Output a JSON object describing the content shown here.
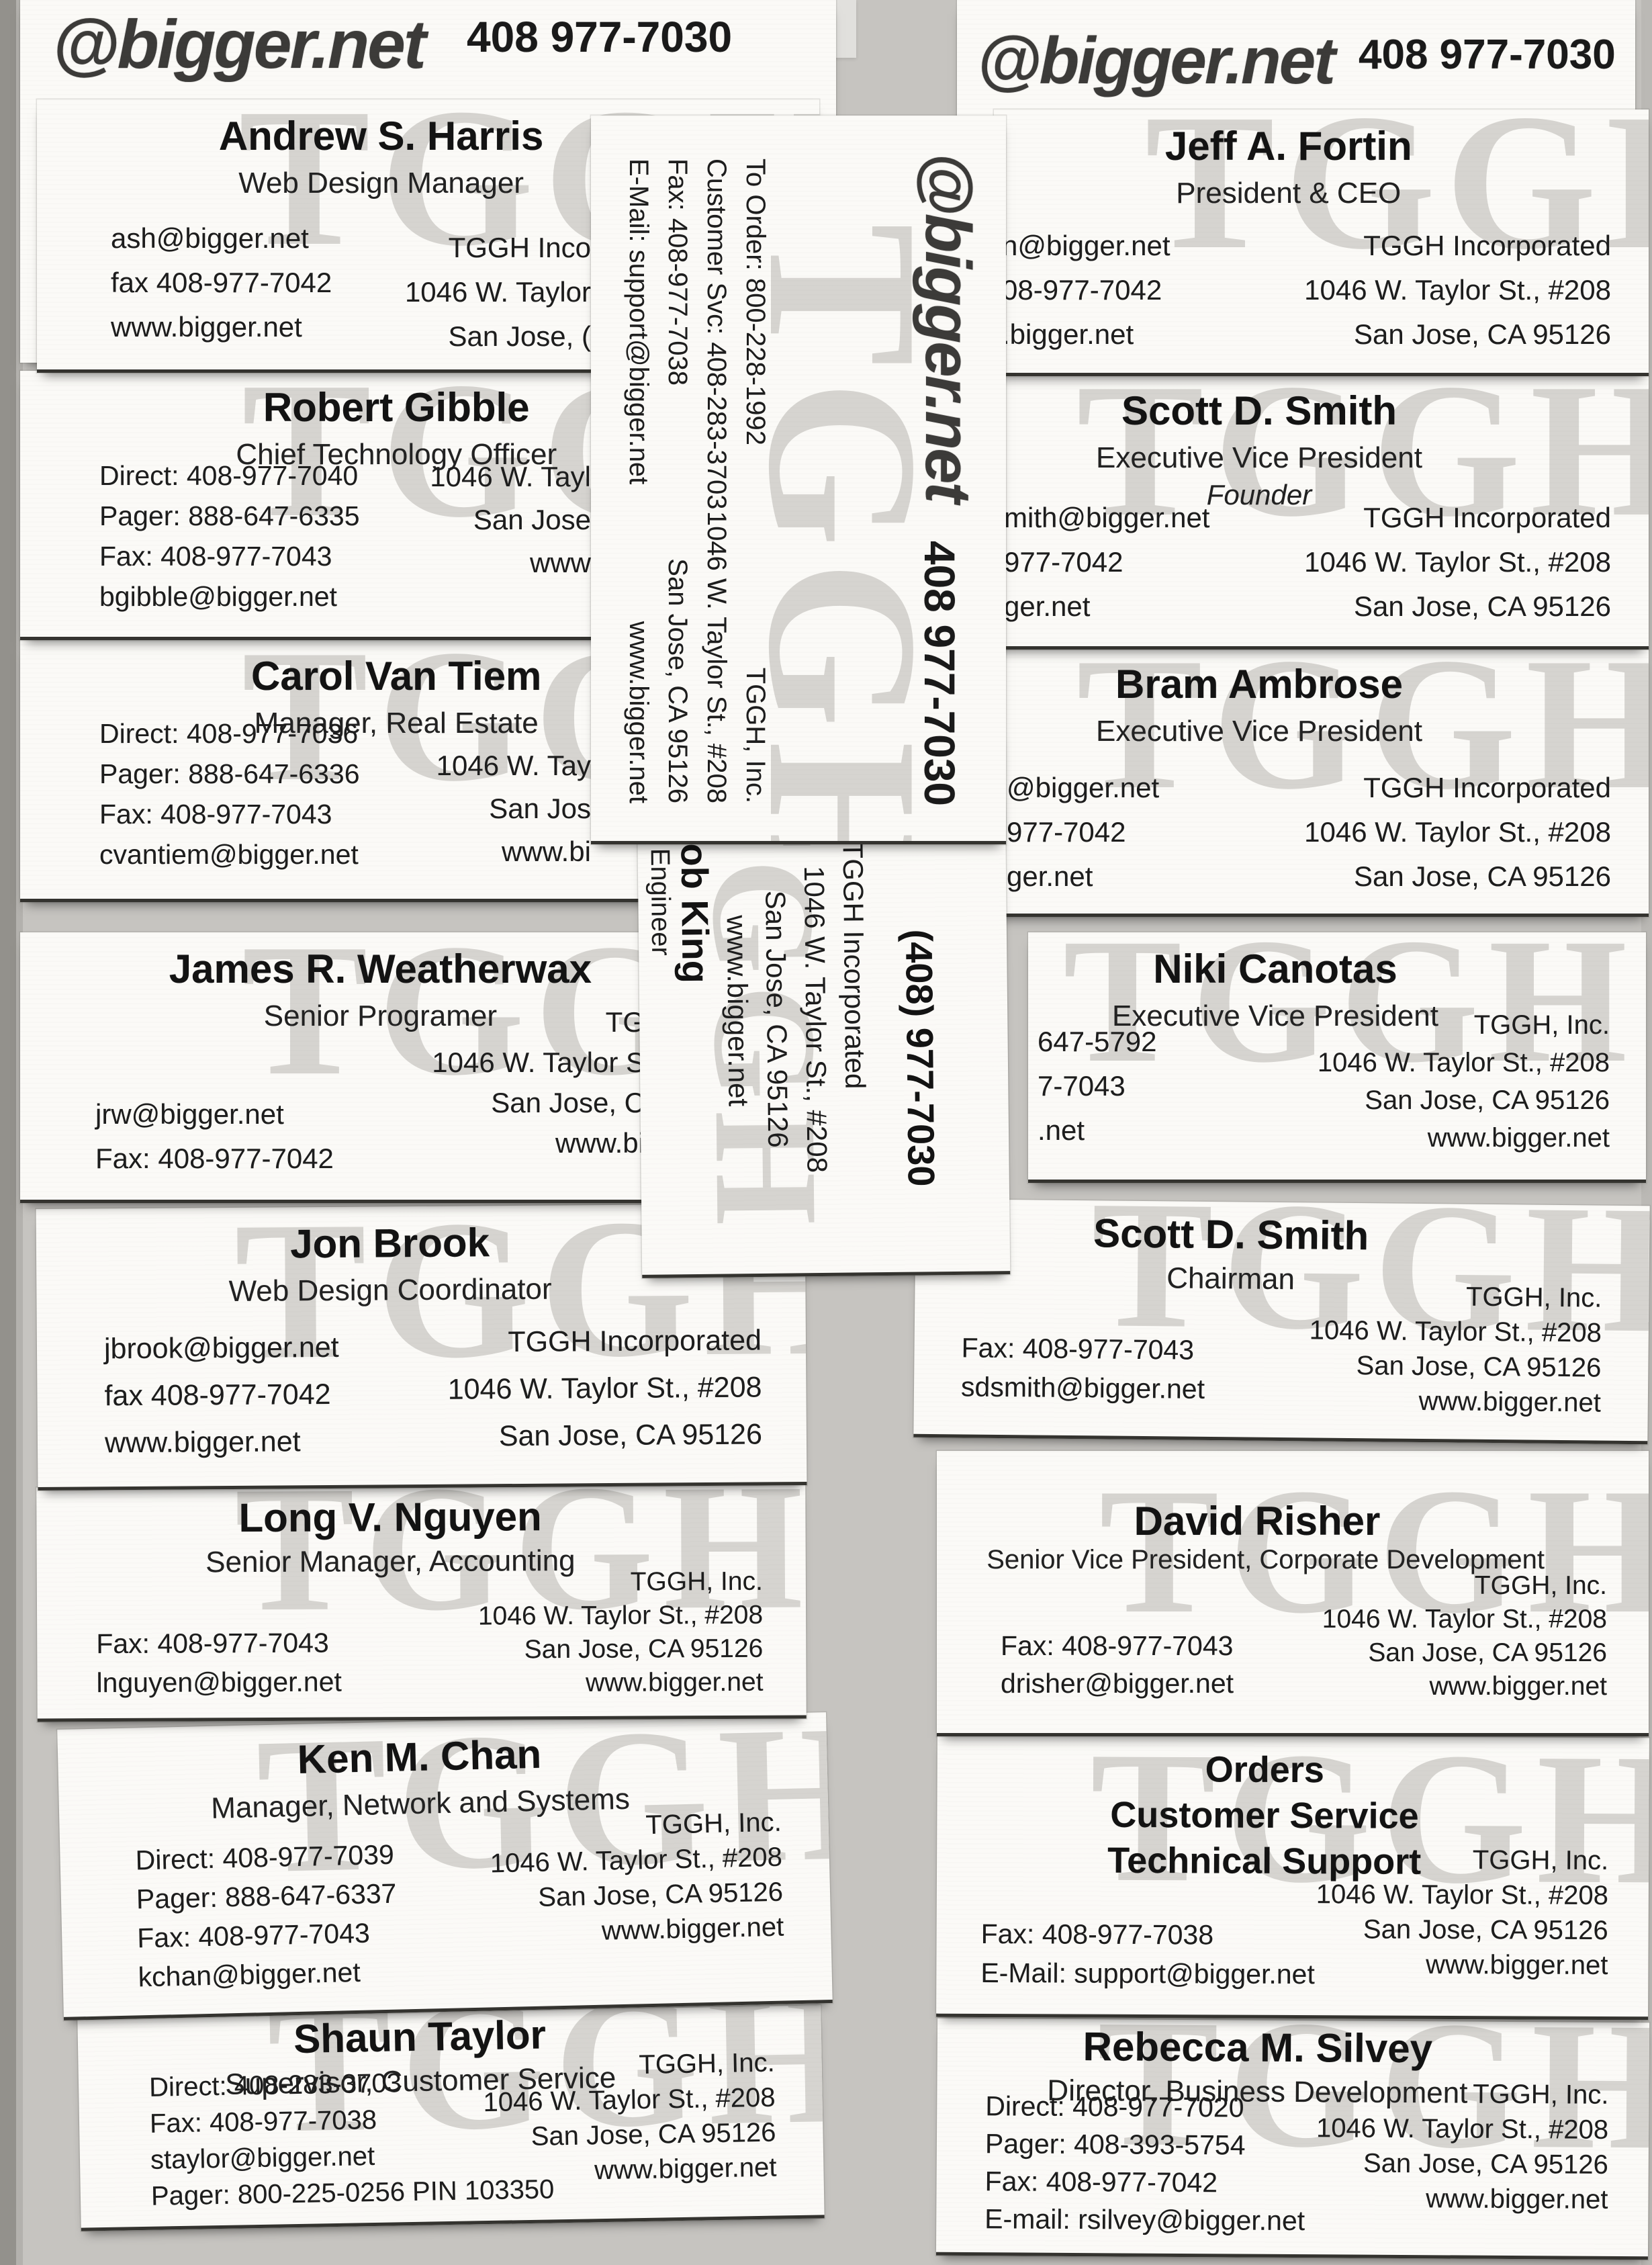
{
  "headers": {
    "left": {
      "logo": "@bigger.net",
      "phone": "408 977-7030"
    },
    "right": {
      "logo": "@bigger.net",
      "phone": "408 977-7030"
    }
  },
  "watermark": "TGGH",
  "cards": {
    "andrew": {
      "name": "Andrew S. Harris",
      "title": "Web Design Manager",
      "left": [
        "ash@bigger.net",
        "fax 408-977-7042",
        "www.bigger.net"
      ],
      "right": [
        "TGGH Inco",
        "1046 W. Taylor",
        "San Jose, ("
      ]
    },
    "fortin": {
      "name": "Jeff A. Fortin",
      "title": "President & CEO",
      "left": [
        "n@bigger.net",
        "08-977-7042",
        ".bigger.net"
      ],
      "right": [
        "TGGH Incorporated",
        "1046 W. Taylor St., #208",
        "San Jose, CA 95126"
      ]
    },
    "gibble": {
      "name": "Robert Gibble",
      "title": "Chief Technology Officer",
      "left": [
        "Direct: 408-977-7040",
        "Pager: 888-647-6335",
        "Fax: 408-977-7043",
        "bgibble@bigger.net"
      ],
      "right": [
        "1046 W. Tayl",
        "San Jose",
        "www"
      ]
    },
    "smith_evp": {
      "name": "Scott D. Smith",
      "title": "Executive Vice President",
      "title2": "Founder",
      "left": [
        "mith@bigger.net",
        "977-7042",
        "ger.net"
      ],
      "right": [
        "TGGH Incorporated",
        "1046 W. Taylor St., #208",
        "San Jose, CA 95126"
      ]
    },
    "vantiem": {
      "name": "Carol Van Tiem",
      "title": "Manager, Real Estate",
      "left": [
        "Direct: 408-977-7036",
        "Pager: 888-647-6336",
        "Fax: 408-977-7043",
        "cvantiem@bigger.net"
      ],
      "right": [
        "1046 W. Tay",
        "San Jos",
        "www.bi"
      ]
    },
    "ambrose": {
      "name": "Bram Ambrose",
      "title": "Executive Vice President",
      "left": [
        "@bigger.net",
        "977-7042",
        "ger.net"
      ],
      "right": [
        "TGGH Incorporated",
        "1046 W. Taylor St., #208",
        "San Jose, CA 95126"
      ]
    },
    "weatherwax": {
      "name": "James R. Weatherwax",
      "title": "Senior Programer",
      "left": [
        "jrw@bigger.net",
        "Fax: 408-977-7042"
      ],
      "right": [
        "TG",
        "1046 W. Taylor S",
        "San Jose, C",
        "www.bi"
      ]
    },
    "canotas": {
      "name": "Niki Canotas",
      "title": "Executive Vice President",
      "left": [
        "647-5792",
        "7-7043",
        ".net"
      ],
      "right": [
        "TGGH, Inc.",
        "1046 W. Taylor St., #208",
        "San Jose, CA 95126",
        "www.bigger.net"
      ]
    },
    "brook": {
      "name": "Jon Brook",
      "title": "Web Design Coordinator",
      "left": [
        "jbrook@bigger.net",
        "fax 408-977-7042",
        "www.bigger.net"
      ],
      "right": [
        "TGGH Incorporated",
        "1046 W. Taylor St., #208",
        "San Jose, CA 95126"
      ]
    },
    "smith_chair": {
      "name": "Scott D. Smith",
      "title": "Chairman",
      "left": [
        "Fax: 408-977-7043",
        "sdsmith@bigger.net"
      ],
      "right": [
        "TGGH, Inc.",
        "1046 W. Taylor St., #208",
        "San Jose, CA 95126",
        "www.bigger.net"
      ]
    },
    "nguyen": {
      "name": "Long V. Nguyen",
      "title": "Senior Manager, Accounting",
      "left": [
        "Fax: 408-977-7043",
        "lnguyen@bigger.net"
      ],
      "right": [
        "TGGH, Inc.",
        "1046 W. Taylor St., #208",
        "San Jose, CA 95126",
        "www.bigger.net"
      ]
    },
    "risher": {
      "name": "David Risher",
      "title": "Senior Vice President, Corporate Development",
      "left": [
        "Fax: 408-977-7043",
        "drisher@bigger.net"
      ],
      "right": [
        "TGGH, Inc.",
        "1046 W. Taylor St., #208",
        "San Jose, CA 95126",
        "www.bigger.net"
      ]
    },
    "chan": {
      "name": "Ken  M. Chan",
      "title": "Manager, Network and Systems",
      "left": [
        "Direct: 408-977-7039",
        "Pager: 888-647-6337",
        "Fax: 408-977-7043",
        "kchan@bigger.net"
      ],
      "right": [
        "TGGH, Inc.",
        "1046 W. Taylor St., #208",
        "San Jose, CA 95126",
        "www.bigger.net"
      ]
    },
    "orders": {
      "name_lines": [
        "Orders",
        "Customer Service",
        "Technical Support"
      ],
      "left": [
        "Fax: 408-977-7038",
        "E-Mail: support@bigger.net"
      ],
      "right": [
        "TGGH, Inc.",
        "1046 W. Taylor St., #208",
        "San Jose, CA 95126",
        "www.bigger.net"
      ]
    },
    "staylor": {
      "name": "Shaun Taylor",
      "title": "Supervisor, Customer Service",
      "left": [
        "Direct: 408-283-3703",
        "Fax: 408-977-7038",
        "staylor@bigger.net",
        "Pager: 800-225-0256 PIN 103350"
      ],
      "right": [
        "TGGH, Inc.",
        "1046 W. Taylor St., #208",
        "San Jose, CA 95126",
        "www.bigger.net"
      ]
    },
    "silvey": {
      "name": "Rebecca M. Silvey",
      "title": "Director, Business Development",
      "left": [
        "Direct: 408-977-7020",
        "Pager: 408-393-5754",
        "Fax: 408-977-7042",
        "E-mail: rsilvey@bigger.net"
      ],
      "right": [
        "TGGH, Inc.",
        "1046 W. Taylor St., #208",
        "San Jose, CA 95126",
        "www.bigger.net"
      ]
    }
  },
  "vertical_card": {
    "logo": "@bigger.net",
    "phone": "408 977-7030",
    "left": [
      "To Order: 800-228-1992",
      "Customer Svc: 408-283-3703",
      "Fax: 408-977-7038",
      "E-Mail: support@bigger.net"
    ],
    "right": [
      "TGGH, Inc.",
      "1046 W. Taylor St., #208",
      "San Jose, CA 95126",
      "www.bigger.net"
    ]
  },
  "bobking": {
    "name": "Bob King",
    "title": "Sales Engineer",
    "phone": "(408) 977-7030",
    "address": [
      "TGGH Incorporated",
      "1046 W. Taylor St., #208",
      "San Jose, CA 95126",
      "www.bigger.net"
    ]
  }
}
